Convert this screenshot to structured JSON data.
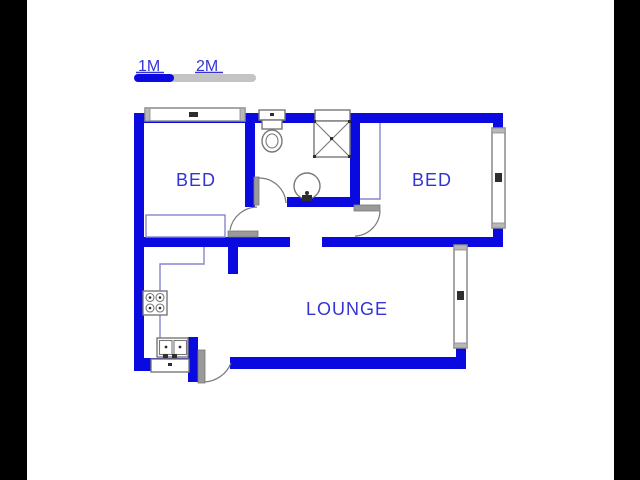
{
  "title": "2 bedroom floor plan",
  "scale_bar": {
    "label_1m": "1M",
    "label_2m": "2M"
  },
  "rooms": [
    {
      "id": "bed-1",
      "label": "BED"
    },
    {
      "id": "bed-2",
      "label": "BED"
    },
    {
      "id": "lounge",
      "label": "LOUNGE"
    }
  ],
  "fixtures": [
    "toilet-icon",
    "shower-icon",
    "basin-icon",
    "stove-icon",
    "double-sink-icon"
  ],
  "openings": {
    "windows": 3,
    "doors": 4
  },
  "colors": {
    "wall": "#0a0ae0",
    "room_label": "#3434d4",
    "counter_line": "#8585cd",
    "fixture_gray": "#787878",
    "leaf_gray": "#9a9a9a",
    "window_border": "#8a8a8a",
    "window_cap": "#b8b8b8",
    "tick_dark": "#2e2e2e",
    "scale_gray": "#c4c4c4",
    "frame_black": "#000000",
    "background": "#ffffff"
  }
}
